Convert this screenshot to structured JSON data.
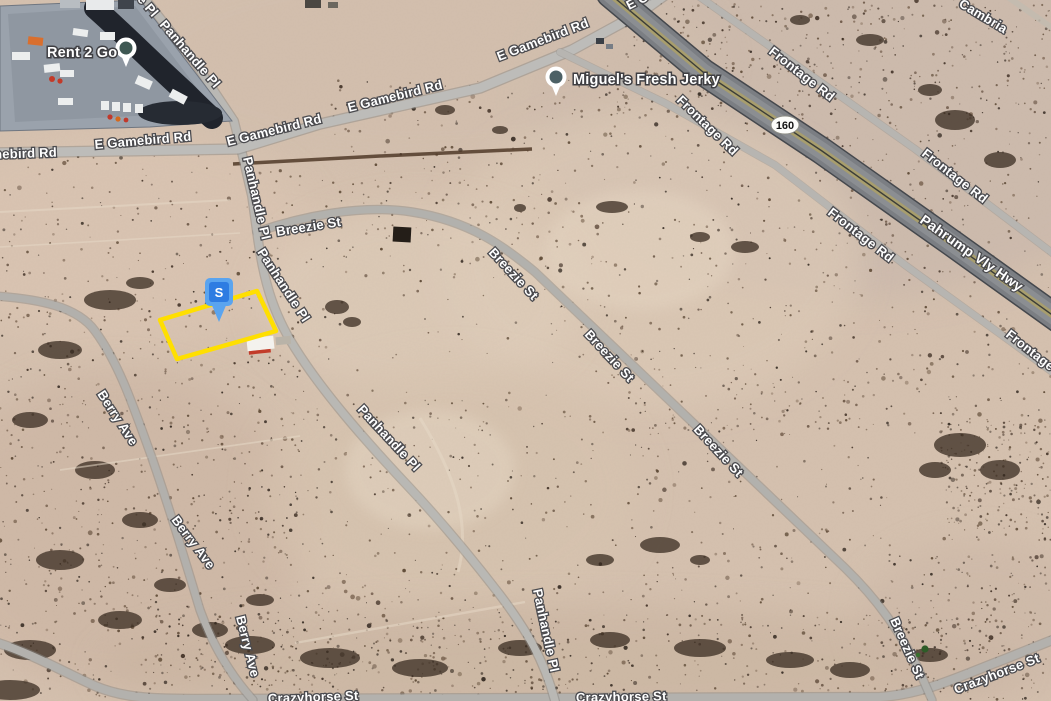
{
  "map": {
    "view_type": "satellite-aerial",
    "road_labels": [
      {
        "text": "E Gamebird Rd",
        "x": -40,
        "y": 160,
        "rot": -2
      },
      {
        "text": "E Gamebird Rd",
        "x": 95,
        "y": 149,
        "rot": -5
      },
      {
        "text": "E Gamebird Rd",
        "x": 228,
        "y": 146,
        "rot": -14
      },
      {
        "text": "E Gamebird Rd",
        "x": 349,
        "y": 112,
        "rot": -14
      },
      {
        "text": "E Gamebird Rd",
        "x": 499,
        "y": 61,
        "rot": -21
      },
      {
        "text": "E Gamebird Rd",
        "x": 629,
        "y": 10,
        "rot": -27
      },
      {
        "text": "Panhandle Pl",
        "x": 97,
        "y": -46,
        "rot": 49
      },
      {
        "text": "Panhandle Pl",
        "x": 159,
        "y": 25,
        "rot": 49
      },
      {
        "text": "Panhandle Pl",
        "x": 243,
        "y": 158,
        "rot": 77
      },
      {
        "text": "Panhandle Pl",
        "x": 257,
        "y": 252,
        "rot": 57
      },
      {
        "text": "Panhandle Pl",
        "x": 357,
        "y": 410,
        "rot": 47
      },
      {
        "text": "Panhandle Pl",
        "x": 533,
        "y": 590,
        "rot": 78
      },
      {
        "text": "Breezie St",
        "x": 277,
        "y": 236,
        "rot": -9
      },
      {
        "text": "Breezie St",
        "x": 488,
        "y": 253,
        "rot": 47
      },
      {
        "text": "Breezie St",
        "x": 584,
        "y": 335,
        "rot": 47
      },
      {
        "text": "Breezie St",
        "x": 693,
        "y": 430,
        "rot": 47
      },
      {
        "text": "Breezie St",
        "x": 890,
        "y": 620,
        "rot": 66
      },
      {
        "text": "Berry Ave",
        "x": 97,
        "y": 394,
        "rot": 57
      },
      {
        "text": "Berry Ave",
        "x": 171,
        "y": 520,
        "rot": 53
      },
      {
        "text": "Berry Ave",
        "x": 236,
        "y": 617,
        "rot": 76
      },
      {
        "text": "Crazyhorse St",
        "x": 268,
        "y": 703,
        "rot": -2
      },
      {
        "text": "Crazyhorse St",
        "x": 576,
        "y": 702,
        "rot": -1
      },
      {
        "text": "Crazyhorse St",
        "x": 956,
        "y": 694,
        "rot": -21
      },
      {
        "text": "Frontage Rd",
        "x": 676,
        "y": 101,
        "rot": 44
      },
      {
        "text": "Frontage Rd",
        "x": 768,
        "y": 53,
        "rot": 38
      },
      {
        "text": "Frontage Rd",
        "x": 827,
        "y": 214,
        "rot": 38
      },
      {
        "text": "Frontage Rd",
        "x": 921,
        "y": 155,
        "rot": 38
      },
      {
        "text": "Frontage Rd",
        "x": 1005,
        "y": 336,
        "rot": 38
      },
      {
        "text": "Pahrump Vly Hwy",
        "x": 919,
        "y": 222,
        "rot": 35,
        "big": true
      },
      {
        "text": "Cambria",
        "x": 958,
        "y": 6,
        "rot": 31
      }
    ],
    "pois": [
      {
        "name": "Rent 2 Go",
        "label_x": 47,
        "label_y": 57,
        "pin_x": 126,
        "pin_y": 48,
        "pin_color": "#3f5853"
      },
      {
        "name": "Miguel's Fresh Jerky",
        "label_x": 573,
        "label_y": 84,
        "pin_x": 556,
        "pin_y": 77,
        "pin_color": "#4d6166"
      }
    ],
    "route_shield": {
      "text": "160",
      "x": 785,
      "y": 125,
      "fill": "#fdfdfa",
      "border": "#8e8e86",
      "text_color": "#151515"
    },
    "parcel": {
      "outline_points": "160,320 257,291 276,331 177,359",
      "outline_color": "#ffdf00",
      "marker": {
        "letter": "S",
        "cx": 219,
        "head_top": 278,
        "head_color": "#5aa4ef",
        "badge_color": "#2e7ce2"
      }
    },
    "colors": {
      "desert": "#d5c1af",
      "road": "#b6b4b0",
      "highway_median": "#a89e6d",
      "highway_asphalt": "#8b8e92"
    }
  }
}
